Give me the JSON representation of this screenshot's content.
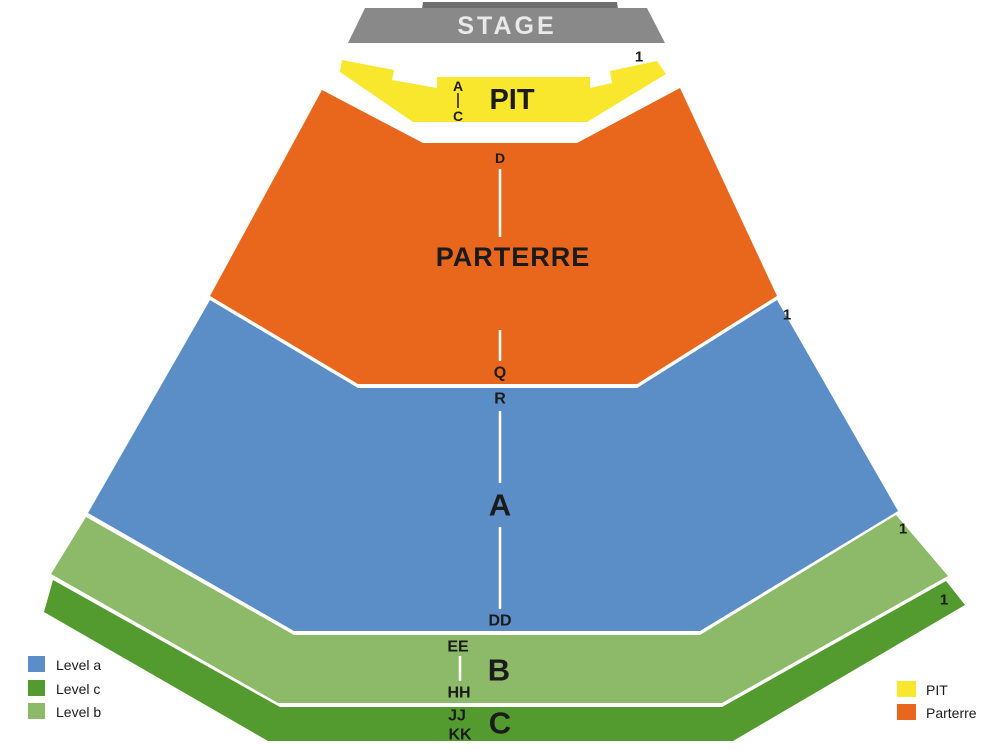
{
  "colors": {
    "stage": "#898989",
    "stage_dark": "#6f6f6f",
    "stage_text": "#e9e9e9",
    "pit": "#f9e72d",
    "parterre": "#e8671d",
    "level_a": "#5b8dc7",
    "level_b": "#8cba68",
    "level_c": "#549b2f",
    "text": "#1b1b1b",
    "separator": "#ffffff"
  },
  "stage": {
    "label": "STAGE"
  },
  "sections": {
    "pit": {
      "label": "PIT"
    },
    "parterre": {
      "label": "PARTERRE"
    },
    "level_a": {
      "label": "A"
    },
    "level_b": {
      "label": "B"
    },
    "level_c": {
      "label": "C"
    }
  },
  "rows": [
    {
      "label": "A"
    },
    {
      "label": "C"
    },
    {
      "label": "D"
    },
    {
      "label": "Q"
    },
    {
      "label": "R"
    },
    {
      "label": "DD"
    },
    {
      "label": "EE"
    },
    {
      "label": "HH"
    },
    {
      "label": "JJ"
    },
    {
      "label": "KK"
    }
  ],
  "row_one_markers": [
    {
      "label": "1"
    },
    {
      "label": "1"
    },
    {
      "label": "1"
    },
    {
      "label": "1"
    }
  ],
  "legend_left": [
    {
      "label": "Level a",
      "color": "#5b8dc7"
    },
    {
      "label": "Level c",
      "color": "#549b2f"
    },
    {
      "label": "Level b",
      "color": "#8cba68"
    }
  ],
  "legend_right": [
    {
      "label": "PIT",
      "color": "#f9e72d"
    },
    {
      "label": "Parterre",
      "color": "#e8671d"
    }
  ]
}
